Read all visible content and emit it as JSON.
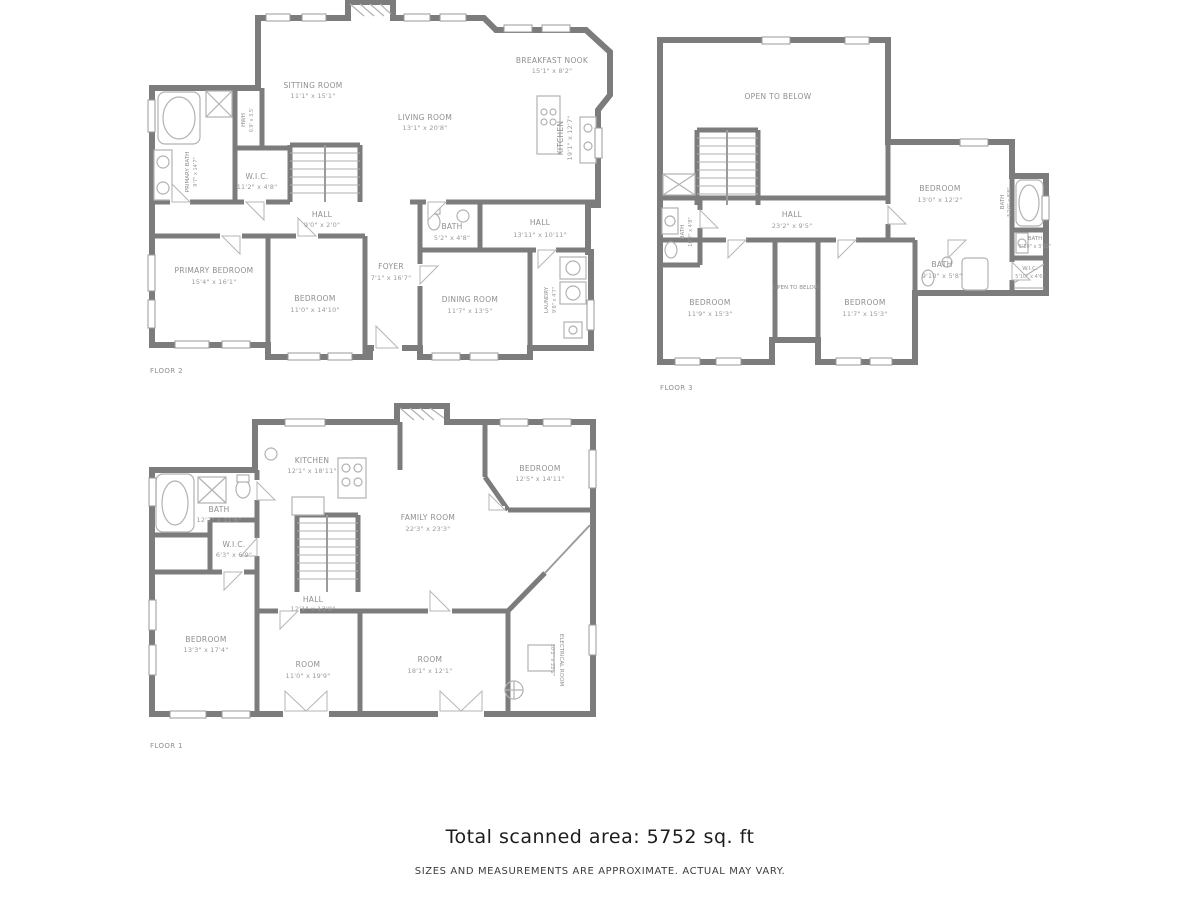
{
  "document": {
    "type": "floor-plan-scan",
    "wall_color": "#7c7c7c",
    "text_color": "#8f8f8f"
  },
  "footer": {
    "total_area": "Total scanned area: 5752 sq. ft",
    "disclaimer": "SIZES AND MEASUREMENTS ARE APPROXIMATE. ACTUAL MAY VARY."
  },
  "floor2": {
    "label": "FLOOR 2",
    "rooms": {
      "sitting": {
        "name": "SITTING ROOM",
        "dims": "11'1\" x 15'1\""
      },
      "living": {
        "name": "LIVING ROOM",
        "dims": "13'1\" x 20'8\""
      },
      "nook": {
        "name": "BREAKFAST NOOK",
        "dims": "15'1\" x 8'2\""
      },
      "kitchen": {
        "name": "KITCHEN",
        "dims": "19'1\" x 12'7\""
      },
      "primary_bath": {
        "name": "PRIMARY BATH",
        "dims": "9'7\" x 14'7\""
      },
      "hwh": {
        "name": "HWH",
        "dims": "0.9' x 3.5'"
      },
      "wic": {
        "name": "W.I.C.",
        "dims": "11'2\" x 4'8\""
      },
      "hall_stairs": {
        "name": "HALL",
        "dims": "9'0\" x 2'0\""
      },
      "primary_bedroom": {
        "name": "PRIMARY BEDROOM",
        "dims": "15'4\" x 16'1\""
      },
      "bedroom": {
        "name": "BEDROOM",
        "dims": "11'0\" x 14'10\""
      },
      "foyer": {
        "name": "FOYER",
        "dims": "7'1\" x 16'7\""
      },
      "bath": {
        "name": "BATH",
        "dims": "5'2\" x 4'8\""
      },
      "hall": {
        "name": "HALL",
        "dims": "13'11\" x 10'11\""
      },
      "dining": {
        "name": "DINING ROOM",
        "dims": "11'7\" x 13'5\""
      },
      "laundry": {
        "name": "LAUNDRY",
        "dims": "9'8\" x 4'7\""
      }
    }
  },
  "floor3": {
    "label": "FLOOR 3",
    "rooms": {
      "open_top": {
        "name": "OPEN TO BELOW",
        "dims": ""
      },
      "bedroom_right": {
        "name": "BEDROOM",
        "dims": "13'0\" x 12'2\""
      },
      "hall": {
        "name": "HALL",
        "dims": "23'2\" x 9'5\""
      },
      "bath_left": {
        "name": "BATH",
        "dims": "10'2\" x 4'8\""
      },
      "bedroom_left": {
        "name": "BEDROOM",
        "dims": "11'9\" x 15'3\""
      },
      "open_mid": {
        "name": "OPEN TO BELOW",
        "dims": ""
      },
      "bedroom_mid": {
        "name": "BEDROOM",
        "dims": "11'7\" x 15'3\""
      },
      "bath_mid": {
        "name": "BATH",
        "dims": "9'10\" x 5'8\""
      },
      "bath_tub": {
        "name": "BATH",
        "dims": "5'10\" x 8'8\""
      },
      "bath_small": {
        "name": "BATH",
        "dims": "5'10\" x 3'10\""
      },
      "wic": {
        "name": "W.I.C.",
        "dims": "5'10\" x 4'6\""
      }
    }
  },
  "floor1": {
    "label": "FLOOR 1",
    "rooms": {
      "kitchen": {
        "name": "KITCHEN",
        "dims": "12'1\" x 18'11\""
      },
      "bedroom_top": {
        "name": "BEDROOM",
        "dims": "12'5\" x 14'11\""
      },
      "family": {
        "name": "FAMILY ROOM",
        "dims": "22'3\" x 23'3\""
      },
      "bath": {
        "name": "BATH",
        "dims": "12'2\" x 11'6\""
      },
      "wic": {
        "name": "W.I.C.",
        "dims": "6'3\" x 6'9\""
      },
      "hall": {
        "name": "HALL",
        "dims": "12'1\" x 13'8\""
      },
      "bedroom_left": {
        "name": "BEDROOM",
        "dims": "13'3\" x 17'4\""
      },
      "room_left": {
        "name": "ROOM",
        "dims": "11'0\" x 19'9\""
      },
      "room_right": {
        "name": "ROOM",
        "dims": "18'1\" x 12'1\""
      },
      "electrical": {
        "name": "ELECTRICAL ROOM",
        "dims": "10'2\" x 22'2\""
      }
    }
  }
}
